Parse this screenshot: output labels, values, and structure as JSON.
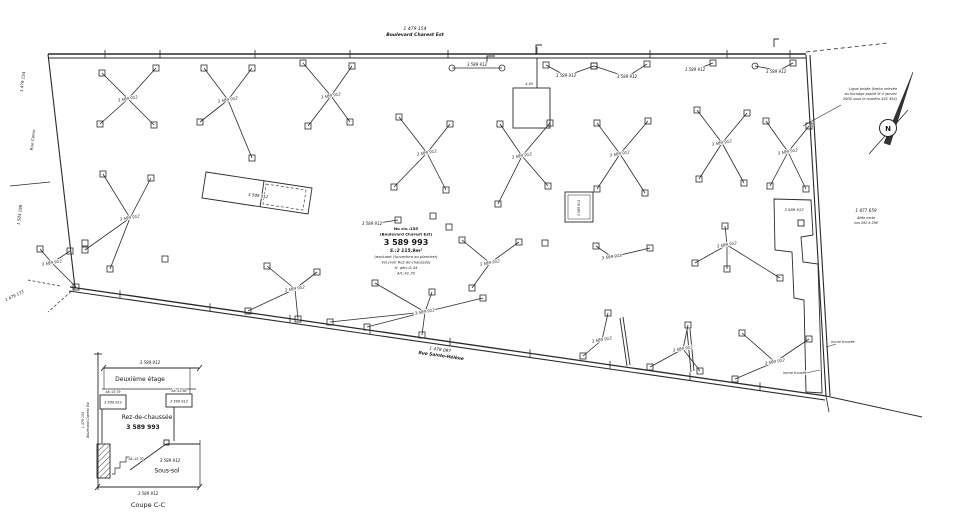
{
  "document_type": "Plan (relevé d'arpentage / coupe)",
  "streets": {
    "top": {
      "lot": "1 479 154",
      "name": "Boulevard Charest Est"
    },
    "bottom": {
      "lot": "1 479 097",
      "name": "Rue Sainte-Hélène"
    },
    "left": {
      "name": "Rue Caron",
      "lot_top": "1 479 154",
      "lot_mid": "1 503 199",
      "lot_corner": "1 479 173"
    },
    "right": {
      "lot": "1 477 659",
      "line2": "Allée verte",
      "line3": "nos 292 à 296"
    }
  },
  "parcel": {
    "civic": "No civ.:155",
    "street_ref": "(Boulevard Charest Est)",
    "lot": "3 589 993",
    "area": "S.:2 115,9m²",
    "note1": "(excluant l'ouverture au plancher)",
    "note2": "Vol.(voir Rez-de-chaussée)",
    "height": "H. gén.:2,44",
    "altitude": "Alt.:41,70"
  },
  "lots": {
    "columns": "3 589 912",
    "secondary": "3 589 913"
  },
  "north": {
    "glyph": "N"
  },
  "north_note": [
    "Ligne brisée (limite relevée",
    "au bornage publié le 4 janvier",
    "2000 sous le numéro 452 454)"
  ],
  "monument": "borne trouvée",
  "dimensions": {
    "square_top": "4,40"
  },
  "section": {
    "title": "Coupe C-C",
    "floor2": "Deuxième étage",
    "floor1": "Rez-de-chaussée",
    "basement": "Sous-sol",
    "lot": "3 589 993",
    "adjacent": "3 589 912",
    "alt_left": "Alt.:43,79",
    "alt_right": "Alt.:43,88",
    "alt_mid": "Alt.:41,70",
    "street_lot": "1 479 154",
    "street": "Boulevard Charest Est"
  },
  "plan_labels": [
    {
      "t": "1 479 154",
      "x": 415,
      "y": 30,
      "s": 4.5,
      "i": 1,
      "n": "street-lot-top"
    },
    {
      "t": "Boulevard Charest Est",
      "x": 415,
      "y": 36,
      "s": 4.6,
      "i": 1,
      "b": 1,
      "n": "street-name-top"
    },
    {
      "t": "1 479 097",
      "x": 440,
      "y": 351,
      "s": 4.3,
      "i": 1,
      "r": 8,
      "n": "street-lot-bottom"
    },
    {
      "t": "Rue Sainte-Hélène",
      "x": 441,
      "y": 357,
      "s": 4.4,
      "i": 1,
      "b": 1,
      "r": 8,
      "n": "street-name-bottom"
    },
    {
      "t": "1 479 154",
      "x": 24,
      "y": 82,
      "s": 4,
      "i": 1,
      "r": -83,
      "n": "left-lot-top"
    },
    {
      "t": "Rue Caron",
      "x": 34,
      "y": 140,
      "s": 4,
      "i": 1,
      "r": -83,
      "n": "street-name-left"
    },
    {
      "t": "1 503 199",
      "x": 21,
      "y": 215,
      "s": 4,
      "i": 1,
      "r": -83,
      "n": "left-lot-mid"
    },
    {
      "t": "1 479 173",
      "x": 15,
      "y": 297,
      "s": 4,
      "i": 1,
      "r": -25,
      "n": "left-lot-corner"
    },
    {
      "t": "1 477 659",
      "x": 866,
      "y": 212,
      "s": 4.2,
      "i": 1,
      "n": "right-lot"
    },
    {
      "t": "Allée verte",
      "x": 866,
      "y": 219,
      "s": 3.3,
      "i": 1,
      "n": "right-lot-note"
    },
    {
      "t": "nos 292 à 296",
      "x": 866,
      "y": 224,
      "s": 3.3,
      "i": 1,
      "n": "right-lot-note"
    },
    {
      "t": "No civ.:155",
      "x": 406,
      "y": 230,
      "s": 3.9,
      "b": 1,
      "n": "parcel-civic"
    },
    {
      "t": "(Boulevard Charest Est)",
      "x": 406,
      "y": 235.5,
      "s": 3.9,
      "b": 1,
      "n": "parcel-street-ref"
    },
    {
      "t": "3 589 993",
      "x": 406,
      "y": 245,
      "s": 8,
      "b": 1,
      "n": "parcel-lot-number"
    },
    {
      "t": "S.:2 115,9m²",
      "x": 406,
      "y": 252,
      "s": 4.5,
      "b": 1,
      "i": 1,
      "n": "parcel-area"
    },
    {
      "t": "(excluant l'ouverture au plancher)",
      "x": 406,
      "y": 258,
      "s": 3.7,
      "i": 1,
      "n": "parcel-note"
    },
    {
      "t": "Vol.(voir Rez-de-chaussée)",
      "x": 406,
      "y": 263.5,
      "s": 3.7,
      "i": 1,
      "n": "parcel-note"
    },
    {
      "t": "H. gén.:2,44",
      "x": 406,
      "y": 269,
      "s": 3.7,
      "i": 1,
      "n": "parcel-height"
    },
    {
      "t": "Alt.:41,70",
      "x": 406,
      "y": 274.5,
      "s": 3.7,
      "i": 1,
      "n": "parcel-altitude"
    },
    {
      "t": "Ligne brisée (limite relevée",
      "x": 897,
      "y": 90,
      "s": 3.5,
      "i": 1,
      "a": "end",
      "n": "north-note"
    },
    {
      "t": "au bornage publié le 4 janvier",
      "x": 897,
      "y": 95,
      "s": 3.5,
      "i": 1,
      "a": "end",
      "n": "north-note"
    },
    {
      "t": "2000 sous le numéro 452 454)",
      "x": 897,
      "y": 100,
      "s": 3.5,
      "i": 1,
      "a": "end",
      "n": "north-note"
    },
    {
      "t": "borne trouvée",
      "x": 843,
      "y": 343,
      "s": 3.3,
      "i": 1,
      "n": "monument-note"
    },
    {
      "t": "borne trouvée",
      "x": 795,
      "y": 374,
      "s": 3.3,
      "i": 1,
      "n": "monument-note"
    },
    {
      "t": "4,40",
      "x": 529,
      "y": 85,
      "s": 3.4,
      "i": 1,
      "n": "dimension-label"
    },
    {
      "t": "N",
      "x": 888,
      "y": 131,
      "s": 7,
      "b": 1,
      "n": "north-letter"
    },
    {
      "t": "3 589 912",
      "x": 128,
      "y": 100,
      "s": 4,
      "i": 1,
      "r": -10,
      "n": "cluster-lot-label"
    },
    {
      "t": "3 589 912",
      "x": 228,
      "y": 101,
      "s": 4,
      "i": 1,
      "r": -10,
      "n": "cluster-lot-label"
    },
    {
      "t": "3 589 912",
      "x": 331,
      "y": 97,
      "s": 4,
      "i": 1,
      "r": -10,
      "n": "cluster-lot-label"
    },
    {
      "t": "3 589 912",
      "x": 427,
      "y": 154,
      "s": 4,
      "i": 1,
      "r": -10,
      "n": "cluster-lot-label"
    },
    {
      "t": "3 589 912",
      "x": 522,
      "y": 157,
      "s": 4,
      "i": 1,
      "r": -10,
      "n": "cluster-lot-label"
    },
    {
      "t": "3 589 912",
      "x": 620,
      "y": 155,
      "s": 4,
      "i": 1,
      "r": -10,
      "n": "cluster-lot-label"
    },
    {
      "t": "3 589 912",
      "x": 722,
      "y": 144,
      "s": 4,
      "i": 1,
      "r": -10,
      "n": "cluster-lot-label"
    },
    {
      "t": "3 589 912",
      "x": 788,
      "y": 153,
      "s": 4,
      "i": 1,
      "r": -10,
      "n": "cluster-lot-label"
    },
    {
      "t": "3 589 912",
      "x": 130,
      "y": 219,
      "s": 4,
      "i": 1,
      "r": -10,
      "n": "cluster-lot-label"
    },
    {
      "t": "3 589 912",
      "x": 52,
      "y": 264,
      "s": 4,
      "i": 1,
      "r": -10,
      "n": "cluster-lot-label"
    },
    {
      "t": "3 589 912",
      "x": 295,
      "y": 290,
      "s": 4,
      "i": 1,
      "r": -10,
      "n": "cluster-lot-label"
    },
    {
      "t": "3 589 912",
      "x": 425,
      "y": 313,
      "s": 4,
      "i": 1,
      "r": -10,
      "n": "cluster-lot-label"
    },
    {
      "t": "3 589 912",
      "x": 602,
      "y": 341,
      "s": 4,
      "i": 1,
      "r": -10,
      "n": "cluster-lot-label"
    },
    {
      "t": "3 589 912",
      "x": 683,
      "y": 350,
      "s": 4,
      "i": 1,
      "r": -10,
      "n": "cluster-lot-label"
    },
    {
      "t": "3 589 912",
      "x": 775,
      "y": 363,
      "s": 4,
      "i": 1,
      "r": -10,
      "n": "cluster-lot-label"
    },
    {
      "t": "3 589 912",
      "x": 727,
      "y": 246,
      "s": 4,
      "i": 1,
      "r": -10,
      "n": "cluster-lot-label"
    },
    {
      "t": "3 589 912",
      "x": 566,
      "y": 77,
      "s": 4,
      "i": 1,
      "n": "cluster-lot-label"
    },
    {
      "t": "3 589 912",
      "x": 627,
      "y": 78,
      "s": 4,
      "i": 1,
      "n": "cluster-lot-label"
    },
    {
      "t": "3 589 912",
      "x": 695,
      "y": 71,
      "s": 4,
      "i": 1,
      "n": "cluster-lot-label"
    },
    {
      "t": "3 589 912",
      "x": 776,
      "y": 73,
      "s": 4,
      "i": 1,
      "n": "cluster-lot-label"
    },
    {
      "t": "3 589 912",
      "x": 372,
      "y": 225,
      "s": 4,
      "i": 1,
      "n": "cluster-lot-label"
    },
    {
      "t": "3 589 912",
      "x": 490,
      "y": 264,
      "s": 4,
      "i": 1,
      "r": -10,
      "n": "cluster-lot-label"
    },
    {
      "t": "3 589 913",
      "x": 612,
      "y": 258,
      "s": 4,
      "i": 1,
      "r": -8,
      "n": "cluster-lot-label"
    },
    {
      "t": "3 589 912",
      "x": 477,
      "y": 66,
      "s": 4,
      "i": 1,
      "n": "servitude-label"
    },
    {
      "t": "3 589 912",
      "x": 258,
      "y": 197,
      "s": 4,
      "i": 1,
      "r": 8,
      "n": "structure-lot-label"
    },
    {
      "t": "3 589 913",
      "x": 580,
      "y": 208,
      "s": 3.2,
      "i": 1,
      "r": -90,
      "n": "structure-lot-label"
    },
    {
      "t": "3 589 912",
      "x": 794,
      "y": 211,
      "s": 3.8,
      "i": 1,
      "n": "structure-lot-label"
    },
    {
      "t": "3 589 912",
      "x": 150,
      "y": 364,
      "s": 4,
      "i": 1,
      "n": "section-lot-label"
    },
    {
      "t": "Deuxième étage",
      "x": 140,
      "y": 381,
      "s": 6,
      "n": "section-floor2-label"
    },
    {
      "t": "Alt.:43,79",
      "x": 113,
      "y": 393,
      "s": 3.1,
      "i": 1,
      "n": "section-alt-label"
    },
    {
      "t": "3 589 912",
      "x": 113,
      "y": 403.5,
      "s": 3.5,
      "i": 1,
      "n": "section-lot-label"
    },
    {
      "t": "Alt.:43,88",
      "x": 179,
      "y": 392,
      "s": 3.1,
      "i": 1,
      "n": "section-alt-label"
    },
    {
      "t": "3 589 912",
      "x": 179,
      "y": 402.5,
      "s": 3.5,
      "i": 1,
      "n": "section-lot-label"
    },
    {
      "t": "Rez-de-chaussée",
      "x": 147,
      "y": 419,
      "s": 6,
      "n": "section-floor1-label"
    },
    {
      "t": "3 589 993",
      "x": 143,
      "y": 429,
      "s": 6,
      "b": 1,
      "n": "section-parcel-lot"
    },
    {
      "t": "Alt.:41,70",
      "x": 136,
      "y": 460,
      "s": 3.1,
      "i": 1,
      "n": "section-alt-label"
    },
    {
      "t": "3 589 912",
      "x": 170,
      "y": 462,
      "s": 4,
      "i": 1,
      "n": "section-lot-label"
    },
    {
      "t": "Sous-sol",
      "x": 167,
      "y": 472.5,
      "s": 6,
      "n": "section-basement-label"
    },
    {
      "t": "3 589 912",
      "x": 148,
      "y": 495,
      "s": 4,
      "i": 1,
      "n": "section-lot-label"
    },
    {
      "t": "Coupe C-C",
      "x": 148,
      "y": 507,
      "s": 6.5,
      "n": "section-title"
    },
    {
      "t": "1 479 154",
      "x": 84,
      "y": 420,
      "s": 3.2,
      "i": 1,
      "r": -90,
      "n": "section-street-lot"
    },
    {
      "t": "Boulevard Charest Est",
      "x": 89,
      "y": 420,
      "s": 3.2,
      "i": 1,
      "r": -90,
      "n": "section-street-name"
    }
  ]
}
